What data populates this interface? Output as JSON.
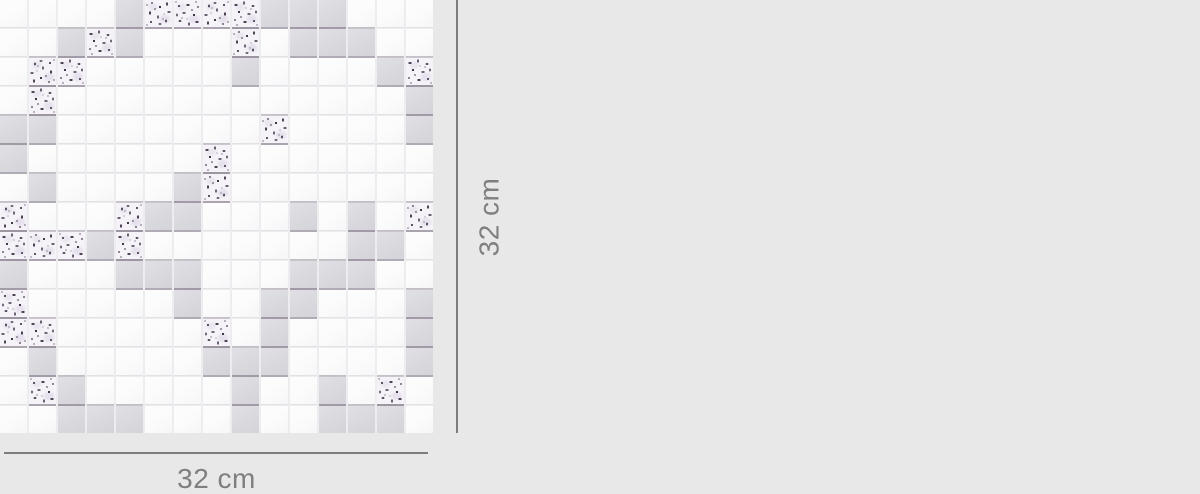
{
  "image": {
    "type": "product-dimension-diagram",
    "subject": "mosaic tile sheet, white / gray / textured glass squares"
  },
  "mosaic": {
    "grid_cols": 15,
    "grid_rows": 15,
    "legend": {
      "W": "white-tile",
      "G": "gray-tile",
      "T": "textured-glass-tile"
    },
    "rows": [
      "WWWWGTTTTGGGWWW",
      "WWGTGWWWTWGGGWW",
      "WTTWWWWWGWWWWGT",
      "WTWWWWWWWWWWWWG",
      "GGWWWWWWWTWWWWG",
      "GWWWWWWTWWWWWWW",
      "WGWWWWGTWWWWWWW",
      "TWWWTGGWWWGWGWT",
      "TTTGTWWWWWWWGGW",
      "GWWWGGGWWWGGGWW",
      "TWWWWWGWWGGWWWG",
      "TTWWWWWTWGWWWWG",
      "WGWWWWWGGGWWWWG",
      "WTGWWWWWGWWGWTW",
      "WWGGGWWWGWWGGGW"
    ]
  },
  "dimensions": {
    "width": {
      "label": "32 cm"
    },
    "height": {
      "label": "32 cm"
    }
  },
  "colors": {
    "background": "#e8e8e8",
    "dimension_line": "#7d7d7d",
    "label_text": "#7f7f7f",
    "tile_white": "#fcfcfc",
    "tile_gray": "#d9d9de",
    "tile_texture_base": "#f5f3f7",
    "texture_speckle": "#4e4456",
    "grout": "#edecee"
  }
}
